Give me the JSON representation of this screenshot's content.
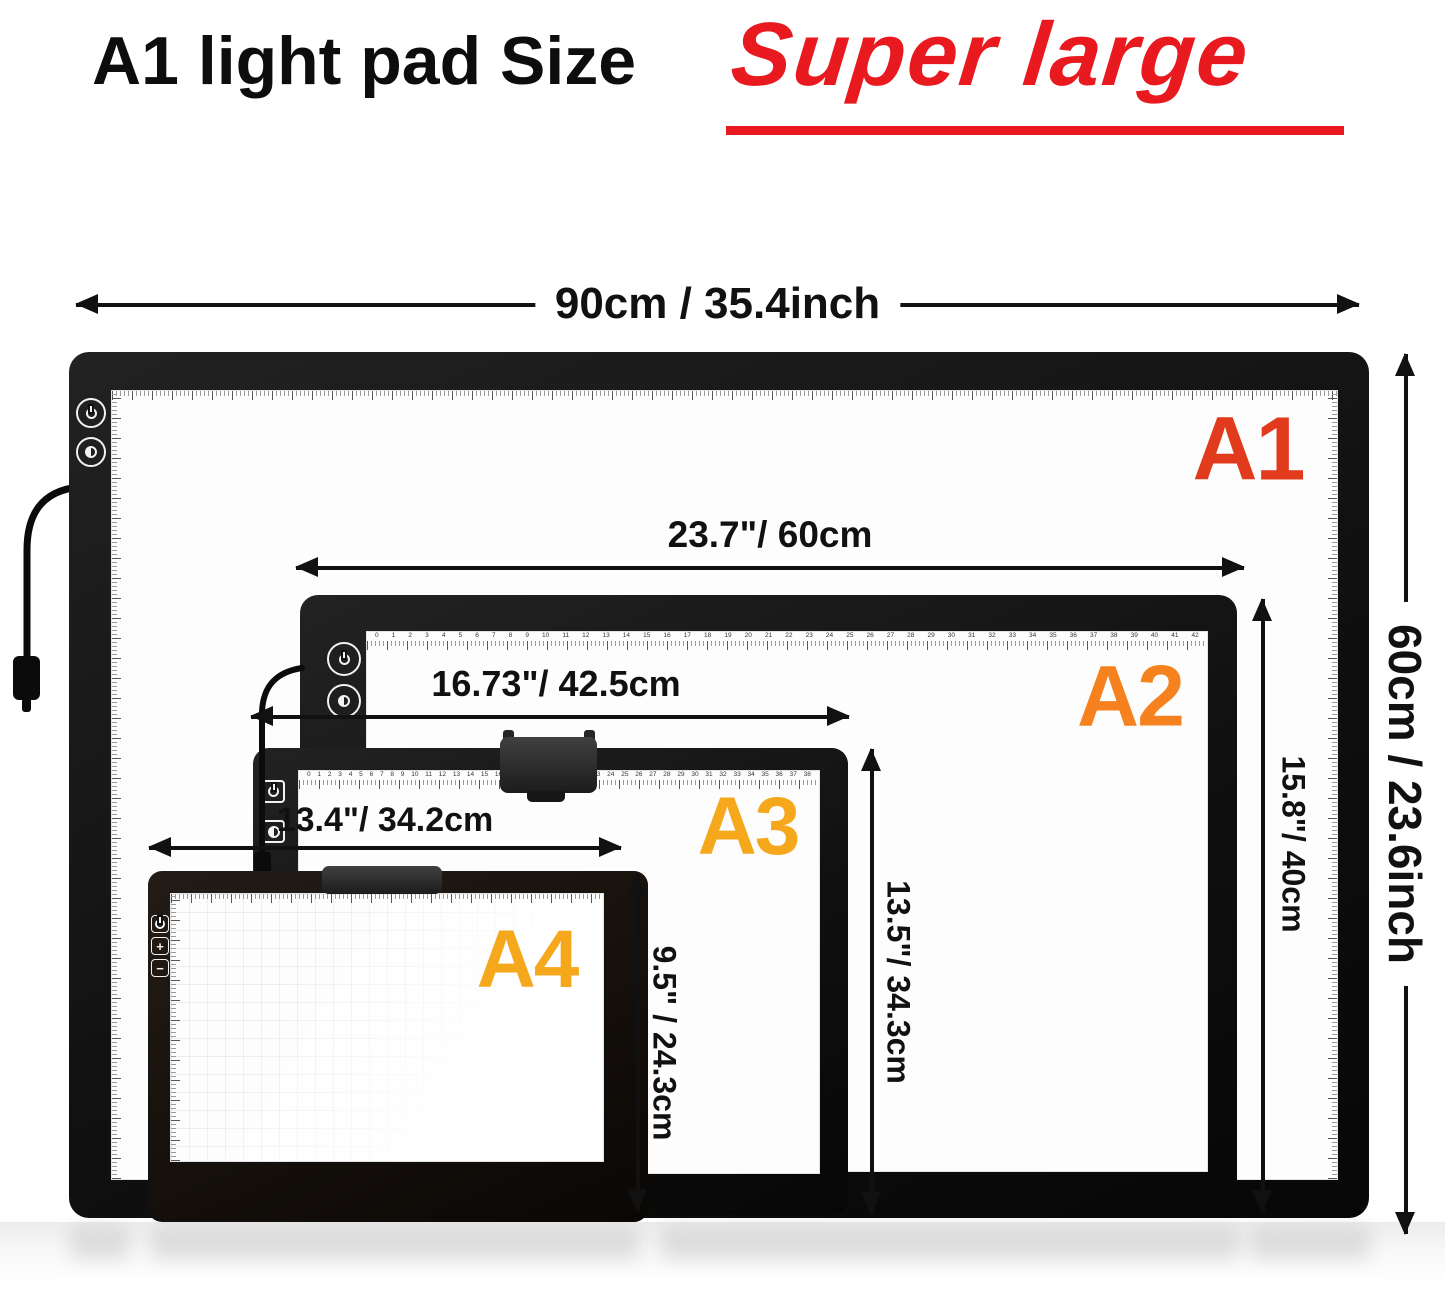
{
  "title": {
    "black": "A1  light pad Size",
    "red": "Super large"
  },
  "labels": {
    "a1": "A1",
    "a2": "A2",
    "a3": "A3",
    "a4": "A4"
  },
  "dimensions": {
    "a1_width": "90cm / 35.4inch",
    "a1_height": "60cm / 23.6inch",
    "a2_width": "23.7\"/ 60cm",
    "a2_height": "15.8\"/ 40cm",
    "a3_width": "16.73\"/ 42.5cm",
    "a3_height": "13.5\"/ 34.3cm",
    "a4_width": "13.4\"/ 34.2cm",
    "a4_height": "9.5\" / 24.3cm"
  },
  "icons": {
    "power": "power-icon",
    "brightness": "brightness-icon",
    "plus": "+",
    "minus": "−"
  },
  "rulers": {
    "a2": {
      "from": 0,
      "to": 42
    },
    "a3": {
      "from": 0,
      "to": 38
    }
  },
  "colors": {
    "title_red": "#e8191f",
    "a1_label": "#e23a1c",
    "a2_label": "#f5821f",
    "a3_label": "#f6a81c",
    "a4_label": "#f6a81c",
    "arrow": "#111111"
  }
}
